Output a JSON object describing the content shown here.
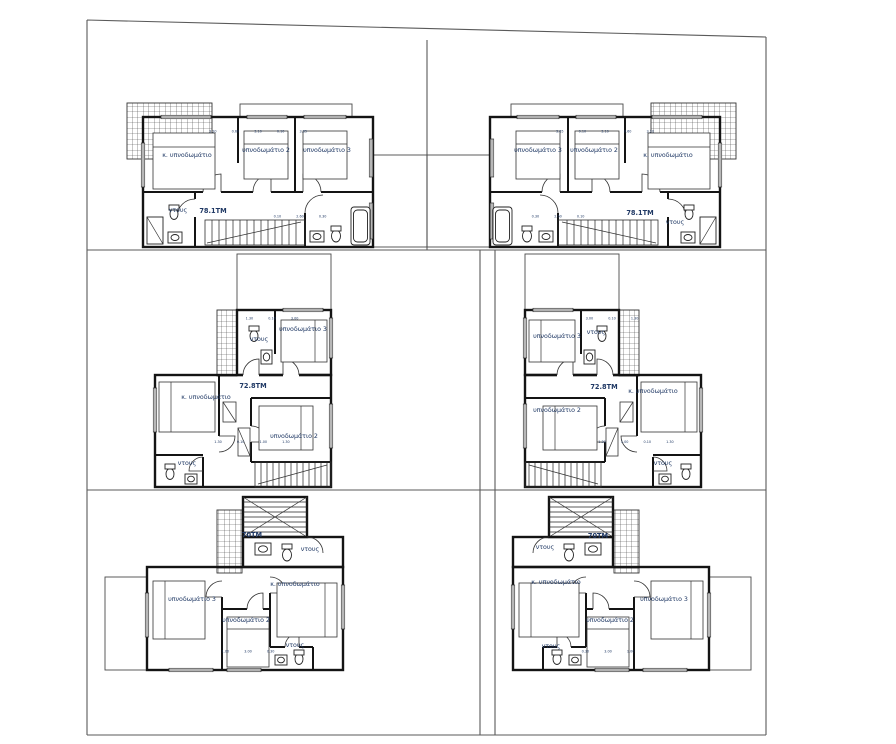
{
  "drawing": {
    "background": "#ffffff",
    "wall_color": "#141414",
    "site_line_color": "#5a5a5a",
    "label_color": "#1f3864"
  },
  "labels": {
    "master_bedroom": "κ. υπνοδωμάτιο",
    "bedroom2": "υπνοδωμάτιο 2",
    "bedroom3": "υπνοδωμάτιο 3",
    "shower": "ντους"
  },
  "units": {
    "top_left": {
      "area": "78.1TM",
      "dims_top": "3.20 0.60 3.10 0.10 3.65",
      "dims_bottom": "0.10 2.60 0.30"
    },
    "top_right": {
      "area": "78.1TM",
      "dims_top": "3.65 0.10 3.10 0.60 3.20",
      "dims_bottom": "0.30 2.60 0.10"
    },
    "mid_left": {
      "area": "72.8TM",
      "dims_top": "1.30 0.10 3.00",
      "dims_bottom": "1.30 0.10 1.00 1.30"
    },
    "mid_right": {
      "area": "72.8TM",
      "dims_top": "3.00 0.10 1.30",
      "dims_bottom": "1.30 1.00 0.10 1.30"
    },
    "bottom_left": {
      "area": "70TM",
      "dims_bottom": "1.00 3.00 0.30"
    },
    "bottom_right": {
      "area": "70TM",
      "dims_bottom": "0.30 3.00 1.00"
    }
  }
}
